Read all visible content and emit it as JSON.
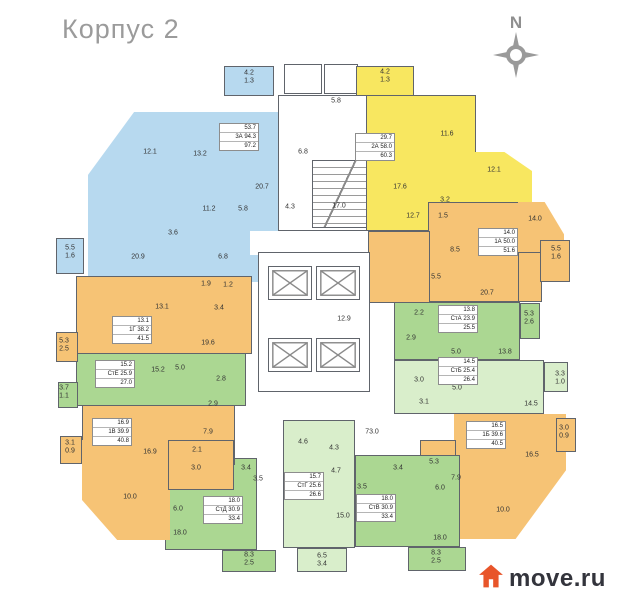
{
  "title": "Корпус 2",
  "compass": {
    "label": "N"
  },
  "brand": {
    "name": "move.ru"
  },
  "legend_colors": {
    "blue": "#b7d9ef",
    "yellow": "#f8e760",
    "orange": "#f6c375",
    "green": "#abd792",
    "light_green": "#d9eecb",
    "logo_orange": "#e8552a",
    "title_gray": "#9b9b9b"
  },
  "apartments": [
    {
      "code": "3А",
      "color": "blue",
      "box": {
        "x": 219,
        "y": 123,
        "lines": [
          "53.7",
          "3А 94.3",
          "97.2"
        ]
      }
    },
    {
      "code": "2А",
      "color": "yellow",
      "box": {
        "x": 355,
        "y": 133,
        "lines": [
          "29.7",
          "2А 58.0",
          "60.3"
        ]
      }
    },
    {
      "code": "1А",
      "color": "orange",
      "box": {
        "x": 478,
        "y": 228,
        "lines": [
          "14.0",
          "1А 50.0",
          "51.6"
        ]
      }
    },
    {
      "code": "СтА",
      "color": "green",
      "box": {
        "x": 438,
        "y": 305,
        "lines": [
          "13.8",
          "СтА 23.9",
          "25.5"
        ]
      }
    },
    {
      "code": "СтБ",
      "color": "light_green",
      "box": {
        "x": 438,
        "y": 357,
        "lines": [
          "14.5",
          "СтБ 25.4",
          "26.4"
        ]
      }
    },
    {
      "code": "1Б",
      "color": "orange",
      "box": {
        "x": 466,
        "y": 421,
        "lines": [
          "16.5",
          "1Б 39.6",
          "40.5"
        ]
      }
    },
    {
      "code": "СтВ",
      "color": "green",
      "box": {
        "x": 356,
        "y": 494,
        "lines": [
          "18.0",
          "СтВ 30.9",
          "33.4"
        ]
      }
    },
    {
      "code": "СтГ",
      "color": "light_green",
      "box": {
        "x": 284,
        "y": 472,
        "lines": [
          "15.7",
          "СтГ 25.6",
          "26.6"
        ]
      }
    },
    {
      "code": "СтД",
      "color": "green",
      "box": {
        "x": 203,
        "y": 496,
        "lines": [
          "18.0",
          "СтД 30.9",
          "33.4"
        ]
      }
    },
    {
      "code": "1В",
      "color": "orange",
      "box": {
        "x": 92,
        "y": 418,
        "lines": [
          "16.9",
          "1В 39.9",
          "40.8"
        ]
      }
    },
    {
      "code": "СтЕ",
      "color": "green",
      "box": {
        "x": 95,
        "y": 360,
        "lines": [
          "15.2",
          "СтЕ 25.9",
          "27.0"
        ]
      }
    },
    {
      "code": "1Г",
      "color": "orange",
      "box": {
        "x": 112,
        "y": 316,
        "lines": [
          "13.1",
          "1Г 38.2",
          "41.5"
        ]
      }
    }
  ],
  "plan": {
    "rooms": [
      {
        "v": "12.1",
        "x": 150,
        "y": 152
      },
      {
        "v": "13.2",
        "x": 200,
        "y": 154
      },
      {
        "v": "20.7",
        "x": 262,
        "y": 187
      },
      {
        "v": "11.2",
        "x": 209,
        "y": 209
      },
      {
        "v": "5.8",
        "x": 243,
        "y": 209
      },
      {
        "v": "3.6",
        "x": 173,
        "y": 233
      },
      {
        "v": "20.9",
        "x": 138,
        "y": 257
      },
      {
        "v": "6.8",
        "x": 223,
        "y": 257
      },
      {
        "v": "4.2",
        "x": 249,
        "y": 73
      },
      {
        "v": "1.3",
        "x": 249,
        "y": 81
      },
      {
        "v": "5.5",
        "x": 70,
        "y": 248
      },
      {
        "v": "1.6",
        "x": 70,
        "y": 256
      },
      {
        "v": "5.8",
        "x": 336,
        "y": 101
      },
      {
        "v": "6.8",
        "x": 303,
        "y": 152
      },
      {
        "v": "4.3",
        "x": 290,
        "y": 207
      },
      {
        "v": "17.0",
        "x": 339,
        "y": 206
      },
      {
        "v": "12.9",
        "x": 344,
        "y": 319
      },
      {
        "v": "73.0",
        "x": 372,
        "y": 432
      },
      {
        "v": "4.2",
        "x": 385,
        "y": 72
      },
      {
        "v": "1.3",
        "x": 385,
        "y": 80
      },
      {
        "v": "11.6",
        "x": 447,
        "y": 134
      },
      {
        "v": "17.6",
        "x": 400,
        "y": 187
      },
      {
        "v": "12.1",
        "x": 494,
        "y": 170
      },
      {
        "v": "3.2",
        "x": 445,
        "y": 200
      },
      {
        "v": "12.7",
        "x": 413,
        "y": 216
      },
      {
        "v": "1.5",
        "x": 443,
        "y": 216
      },
      {
        "v": "14.0",
        "x": 535,
        "y": 219
      },
      {
        "v": "8.5",
        "x": 455,
        "y": 250
      },
      {
        "v": "5.5",
        "x": 436,
        "y": 277
      },
      {
        "v": "20.7",
        "x": 487,
        "y": 293
      },
      {
        "v": "5.5",
        "x": 556,
        "y": 249
      },
      {
        "v": "1.6",
        "x": 556,
        "y": 257
      },
      {
        "v": "2.2",
        "x": 419,
        "y": 313
      },
      {
        "v": "2.9",
        "x": 411,
        "y": 338
      },
      {
        "v": "5.0",
        "x": 456,
        "y": 352
      },
      {
        "v": "13.8",
        "x": 505,
        "y": 352
      },
      {
        "v": "5.3",
        "x": 529,
        "y": 314
      },
      {
        "v": "2.6",
        "x": 529,
        "y": 322
      },
      {
        "v": "3.0",
        "x": 419,
        "y": 380
      },
      {
        "v": "5.0",
        "x": 457,
        "y": 388
      },
      {
        "v": "3.1",
        "x": 424,
        "y": 402
      },
      {
        "v": "14.5",
        "x": 531,
        "y": 404
      },
      {
        "v": "3.3",
        "x": 560,
        "y": 374
      },
      {
        "v": "1.0",
        "x": 560,
        "y": 382
      },
      {
        "v": "16.5",
        "x": 532,
        "y": 455
      },
      {
        "v": "5.3",
        "x": 434,
        "y": 462
      },
      {
        "v": "7.9",
        "x": 456,
        "y": 478
      },
      {
        "v": "10.0",
        "x": 503,
        "y": 510
      },
      {
        "v": "3.0",
        "x": 564,
        "y": 428
      },
      {
        "v": "0.9",
        "x": 564,
        "y": 436
      },
      {
        "v": "3.4",
        "x": 398,
        "y": 468
      },
      {
        "v": "3.5",
        "x": 362,
        "y": 487
      },
      {
        "v": "6.0",
        "x": 440,
        "y": 488
      },
      {
        "v": "18.0",
        "x": 440,
        "y": 538
      },
      {
        "v": "8.3",
        "x": 436,
        "y": 553
      },
      {
        "v": "2.5",
        "x": 436,
        "y": 561
      },
      {
        "v": "4.6",
        "x": 303,
        "y": 442
      },
      {
        "v": "4.3",
        "x": 334,
        "y": 448
      },
      {
        "v": "4.7",
        "x": 336,
        "y": 471
      },
      {
        "v": "15.0",
        "x": 343,
        "y": 516
      },
      {
        "v": "6.5",
        "x": 322,
        "y": 556
      },
      {
        "v": "3.4",
        "x": 322,
        "y": 564
      },
      {
        "v": "3.4",
        "x": 246,
        "y": 468
      },
      {
        "v": "3.5",
        "x": 258,
        "y": 479
      },
      {
        "v": "6.0",
        "x": 178,
        "y": 509
      },
      {
        "v": "18.0",
        "x": 180,
        "y": 533
      },
      {
        "v": "8.3",
        "x": 249,
        "y": 555
      },
      {
        "v": "2.5",
        "x": 249,
        "y": 563
      },
      {
        "v": "7.9",
        "x": 208,
        "y": 432
      },
      {
        "v": "2.1",
        "x": 197,
        "y": 450
      },
      {
        "v": "16.9",
        "x": 150,
        "y": 452
      },
      {
        "v": "3.0",
        "x": 196,
        "y": 468
      },
      {
        "v": "10.0",
        "x": 130,
        "y": 497
      },
      {
        "v": "3.1",
        "x": 70,
        "y": 443
      },
      {
        "v": "0.9",
        "x": 70,
        "y": 451
      },
      {
        "v": "15.2",
        "x": 158,
        "y": 370
      },
      {
        "v": "5.0",
        "x": 180,
        "y": 368
      },
      {
        "v": "2.8",
        "x": 221,
        "y": 379
      },
      {
        "v": "2.9",
        "x": 213,
        "y": 404
      },
      {
        "v": "3.7",
        "x": 64,
        "y": 388
      },
      {
        "v": "1.1",
        "x": 64,
        "y": 396
      },
      {
        "v": "13.1",
        "x": 162,
        "y": 307
      },
      {
        "v": "3.4",
        "x": 219,
        "y": 308
      },
      {
        "v": "19.6",
        "x": 208,
        "y": 343
      },
      {
        "v": "1.9",
        "x": 206,
        "y": 284
      },
      {
        "v": "1.2",
        "x": 228,
        "y": 285
      },
      {
        "v": "5.3",
        "x": 64,
        "y": 341
      },
      {
        "v": "2.5",
        "x": 64,
        "y": 349
      }
    ]
  }
}
